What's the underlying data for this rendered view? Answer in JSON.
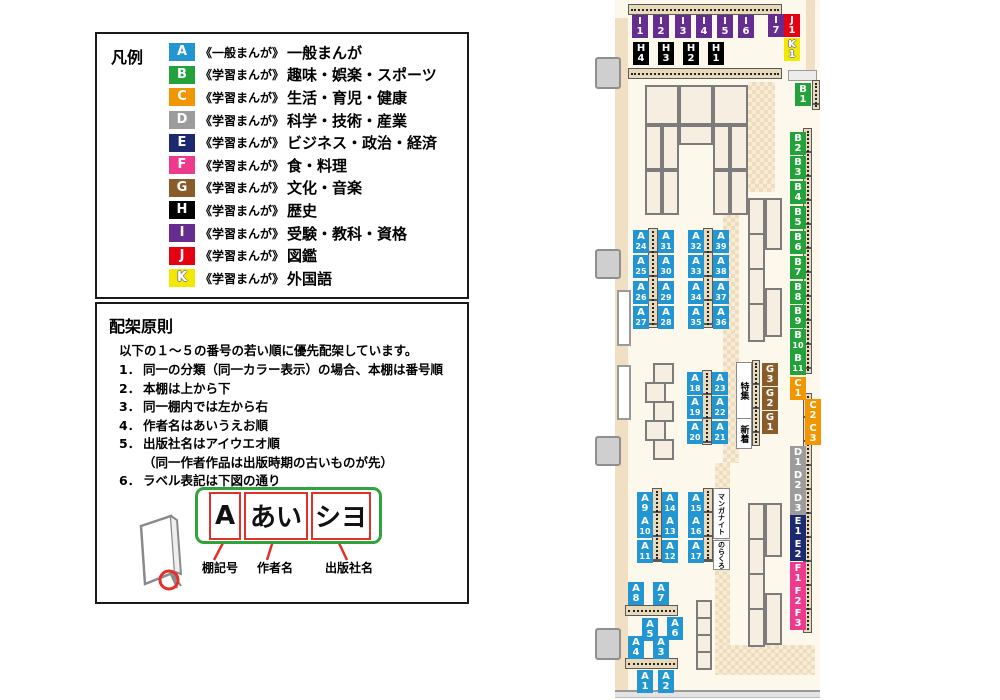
{
  "colors": {
    "A": "#2196d3",
    "B": "#23a23b",
    "C": "#f29600",
    "D": "#9c9c9c",
    "E": "#1b2a70",
    "F": "#ee3a8c",
    "G": "#8a5c2a",
    "H": "#000000",
    "I": "#662d91",
    "J": "#e60012",
    "K": "#f2e800"
  },
  "legend": {
    "title": "凡例",
    "items": [
      {
        "code": "A",
        "color": "#2196d3",
        "prefix": "《一般まんが》",
        "label": "一般まんが"
      },
      {
        "code": "B",
        "color": "#23a23b",
        "prefix": "《学習まんが》",
        "label": "趣味・娯楽・スポーツ"
      },
      {
        "code": "C",
        "color": "#f29600",
        "prefix": "《学習まんが》",
        "label": "生活・育児・健康"
      },
      {
        "code": "D",
        "color": "#9c9c9c",
        "prefix": "《学習まんが》",
        "label": "科学・技術・産業"
      },
      {
        "code": "E",
        "color": "#1b2a70",
        "prefix": "《学習まんが》",
        "label": "ビジネス・政治・経済"
      },
      {
        "code": "F",
        "color": "#ee3a8c",
        "prefix": "《学習まんが》",
        "label": "食・料理"
      },
      {
        "code": "G",
        "color": "#8a5c2a",
        "prefix": "《学習まんが》",
        "label": "文化・音楽"
      },
      {
        "code": "H",
        "color": "#000000",
        "prefix": "《学習まんが》",
        "label": "歴史"
      },
      {
        "code": "I",
        "color": "#662d91",
        "prefix": "《学習まんが》",
        "label": "受験・教科・資格"
      },
      {
        "code": "J",
        "color": "#e60012",
        "prefix": "《学習まんが》",
        "label": "図鑑"
      },
      {
        "code": "K",
        "color": "#f2e800",
        "prefix": "《学習まんが》",
        "label": "外国語"
      }
    ]
  },
  "rules": {
    "title": "配架原則",
    "intro": "以下の１～５の番号の若い順に優先配架しています。",
    "items": [
      {
        "num": "1．",
        "text": "同一の分類（同一カラー表示）の場合、本棚は番号順"
      },
      {
        "num": "2．",
        "text": "本棚は上から下"
      },
      {
        "num": "3．",
        "text": "同一棚内では左から右"
      },
      {
        "num": "4．",
        "text": "作者名はあいうえお順"
      },
      {
        "num": "5．",
        "text": "出版社名はアイウエオ順",
        "sub": "（同一作者作品は出版時期の古いものが先）"
      },
      {
        "num": "6．",
        "text": "ラベル表記は下図の通り"
      }
    ],
    "label_example": {
      "boxes": [
        "A",
        "あい",
        "シヨ"
      ],
      "captions": [
        "棚記号",
        "作者名",
        "出版社名"
      ]
    }
  },
  "map": {
    "labels": [
      {
        "c": "I",
        "n": "1",
        "x": 42,
        "y": 15
      },
      {
        "c": "I",
        "n": "2",
        "x": 63,
        "y": 15
      },
      {
        "c": "I",
        "n": "3",
        "x": 85,
        "y": 15
      },
      {
        "c": "I",
        "n": "4",
        "x": 106,
        "y": 15
      },
      {
        "c": "I",
        "n": "5",
        "x": 127,
        "y": 15
      },
      {
        "c": "I",
        "n": "6",
        "x": 148,
        "y": 15
      },
      {
        "c": "I",
        "n": "7",
        "x": 178,
        "y": 14
      },
      {
        "c": "J",
        "n": "1",
        "x": 194,
        "y": 14
      },
      {
        "c": "K",
        "n": "1",
        "x": 194,
        "y": 38
      },
      {
        "c": "H",
        "n": "4",
        "x": 43,
        "y": 42
      },
      {
        "c": "H",
        "n": "3",
        "x": 68,
        "y": 42
      },
      {
        "c": "H",
        "n": "2",
        "x": 93,
        "y": 42
      },
      {
        "c": "H",
        "n": "1",
        "x": 118,
        "y": 42
      },
      {
        "c": "B",
        "n": "1",
        "x": 205,
        "y": 83
      },
      {
        "c": "B",
        "n": "2",
        "x": 200,
        "y": 132
      },
      {
        "c": "B",
        "n": "3",
        "x": 200,
        "y": 156
      },
      {
        "c": "B",
        "n": "4",
        "x": 200,
        "y": 181
      },
      {
        "c": "B",
        "n": "5",
        "x": 200,
        "y": 206
      },
      {
        "c": "B",
        "n": "6",
        "x": 200,
        "y": 231
      },
      {
        "c": "B",
        "n": "7",
        "x": 200,
        "y": 256
      },
      {
        "c": "B",
        "n": "8",
        "x": 200,
        "y": 281
      },
      {
        "c": "B",
        "n": "9",
        "x": 200,
        "y": 305
      },
      {
        "c": "B",
        "n": "10",
        "x": 200,
        "y": 329
      },
      {
        "c": "B",
        "n": "11",
        "x": 200,
        "y": 352
      },
      {
        "c": "C",
        "n": "1",
        "x": 200,
        "y": 377
      },
      {
        "c": "C",
        "n": "2",
        "x": 215,
        "y": 399
      },
      {
        "c": "C",
        "n": "3",
        "x": 215,
        "y": 422
      },
      {
        "c": "D",
        "n": "1",
        "x": 200,
        "y": 446
      },
      {
        "c": "D",
        "n": "2",
        "x": 200,
        "y": 469
      },
      {
        "c": "D",
        "n": "3",
        "x": 200,
        "y": 492
      },
      {
        "c": "E",
        "n": "1",
        "x": 200,
        "y": 515
      },
      {
        "c": "E",
        "n": "2",
        "x": 200,
        "y": 538
      },
      {
        "c": "F",
        "n": "1",
        "x": 200,
        "y": 562
      },
      {
        "c": "F",
        "n": "2",
        "x": 200,
        "y": 585
      },
      {
        "c": "F",
        "n": "3",
        "x": 200,
        "y": 607
      },
      {
        "c": "G",
        "n": "3",
        "x": 172,
        "y": 363
      },
      {
        "c": "G",
        "n": "2",
        "x": 172,
        "y": 387
      },
      {
        "c": "G",
        "n": "1",
        "x": 172,
        "y": 411
      },
      {
        "c": "A",
        "n": "24",
        "x": 43,
        "y": 230
      },
      {
        "c": "A",
        "n": "25",
        "x": 43,
        "y": 255
      },
      {
        "c": "A",
        "n": "26",
        "x": 43,
        "y": 281
      },
      {
        "c": "A",
        "n": "27",
        "x": 43,
        "y": 306
      },
      {
        "c": "A",
        "n": "31",
        "x": 68,
        "y": 230
      },
      {
        "c": "A",
        "n": "30",
        "x": 68,
        "y": 255
      },
      {
        "c": "A",
        "n": "29",
        "x": 68,
        "y": 281
      },
      {
        "c": "A",
        "n": "28",
        "x": 68,
        "y": 306
      },
      {
        "c": "A",
        "n": "32",
        "x": 98,
        "y": 230
      },
      {
        "c": "A",
        "n": "33",
        "x": 98,
        "y": 255
      },
      {
        "c": "A",
        "n": "34",
        "x": 98,
        "y": 281
      },
      {
        "c": "A",
        "n": "35",
        "x": 98,
        "y": 306
      },
      {
        "c": "A",
        "n": "39",
        "x": 123,
        "y": 230
      },
      {
        "c": "A",
        "n": "38",
        "x": 123,
        "y": 255
      },
      {
        "c": "A",
        "n": "37",
        "x": 123,
        "y": 281
      },
      {
        "c": "A",
        "n": "36",
        "x": 123,
        "y": 306
      },
      {
        "c": "A",
        "n": "18",
        "x": 97,
        "y": 372
      },
      {
        "c": "A",
        "n": "19",
        "x": 97,
        "y": 396
      },
      {
        "c": "A",
        "n": "20",
        "x": 97,
        "y": 421
      },
      {
        "c": "A",
        "n": "23",
        "x": 122,
        "y": 372
      },
      {
        "c": "A",
        "n": "22",
        "x": 122,
        "y": 396
      },
      {
        "c": "A",
        "n": "21",
        "x": 122,
        "y": 421
      },
      {
        "c": "A",
        "n": "9",
        "x": 47,
        "y": 492
      },
      {
        "c": "A",
        "n": "10",
        "x": 47,
        "y": 515
      },
      {
        "c": "A",
        "n": "11",
        "x": 47,
        "y": 540
      },
      {
        "c": "A",
        "n": "14",
        "x": 72,
        "y": 492
      },
      {
        "c": "A",
        "n": "13",
        "x": 72,
        "y": 515
      },
      {
        "c": "A",
        "n": "12",
        "x": 72,
        "y": 540
      },
      {
        "c": "A",
        "n": "15",
        "x": 98,
        "y": 492
      },
      {
        "c": "A",
        "n": "16",
        "x": 98,
        "y": 515
      },
      {
        "c": "A",
        "n": "17",
        "x": 98,
        "y": 540
      },
      {
        "c": "A",
        "n": "8",
        "x": 38,
        "y": 582
      },
      {
        "c": "A",
        "n": "7",
        "x": 63,
        "y": 582
      },
      {
        "c": "A",
        "n": "5",
        "x": 52,
        "y": 618
      },
      {
        "c": "A",
        "n": "6",
        "x": 77,
        "y": 617
      },
      {
        "c": "A",
        "n": "4",
        "x": 38,
        "y": 636
      },
      {
        "c": "A",
        "n": "3",
        "x": 63,
        "y": 636
      },
      {
        "c": "A",
        "n": "1",
        "x": 47,
        "y": 670
      },
      {
        "c": "A",
        "n": "2",
        "x": 68,
        "y": 670
      }
    ],
    "text_boxes": [
      {
        "text": "特集",
        "x": 146,
        "y": 362,
        "w": 14,
        "h": 55,
        "fs": 9
      },
      {
        "text": "新着",
        "x": 146,
        "y": 418,
        "w": 14,
        "h": 29,
        "fs": 9
      },
      {
        "text": "マンガナイト",
        "x": 123,
        "y": 488,
        "w": 15,
        "h": 49,
        "fs": 7
      },
      {
        "text": "のらくろ",
        "x": 123,
        "y": 540,
        "w": 15,
        "h": 28,
        "fs": 7
      }
    ]
  }
}
